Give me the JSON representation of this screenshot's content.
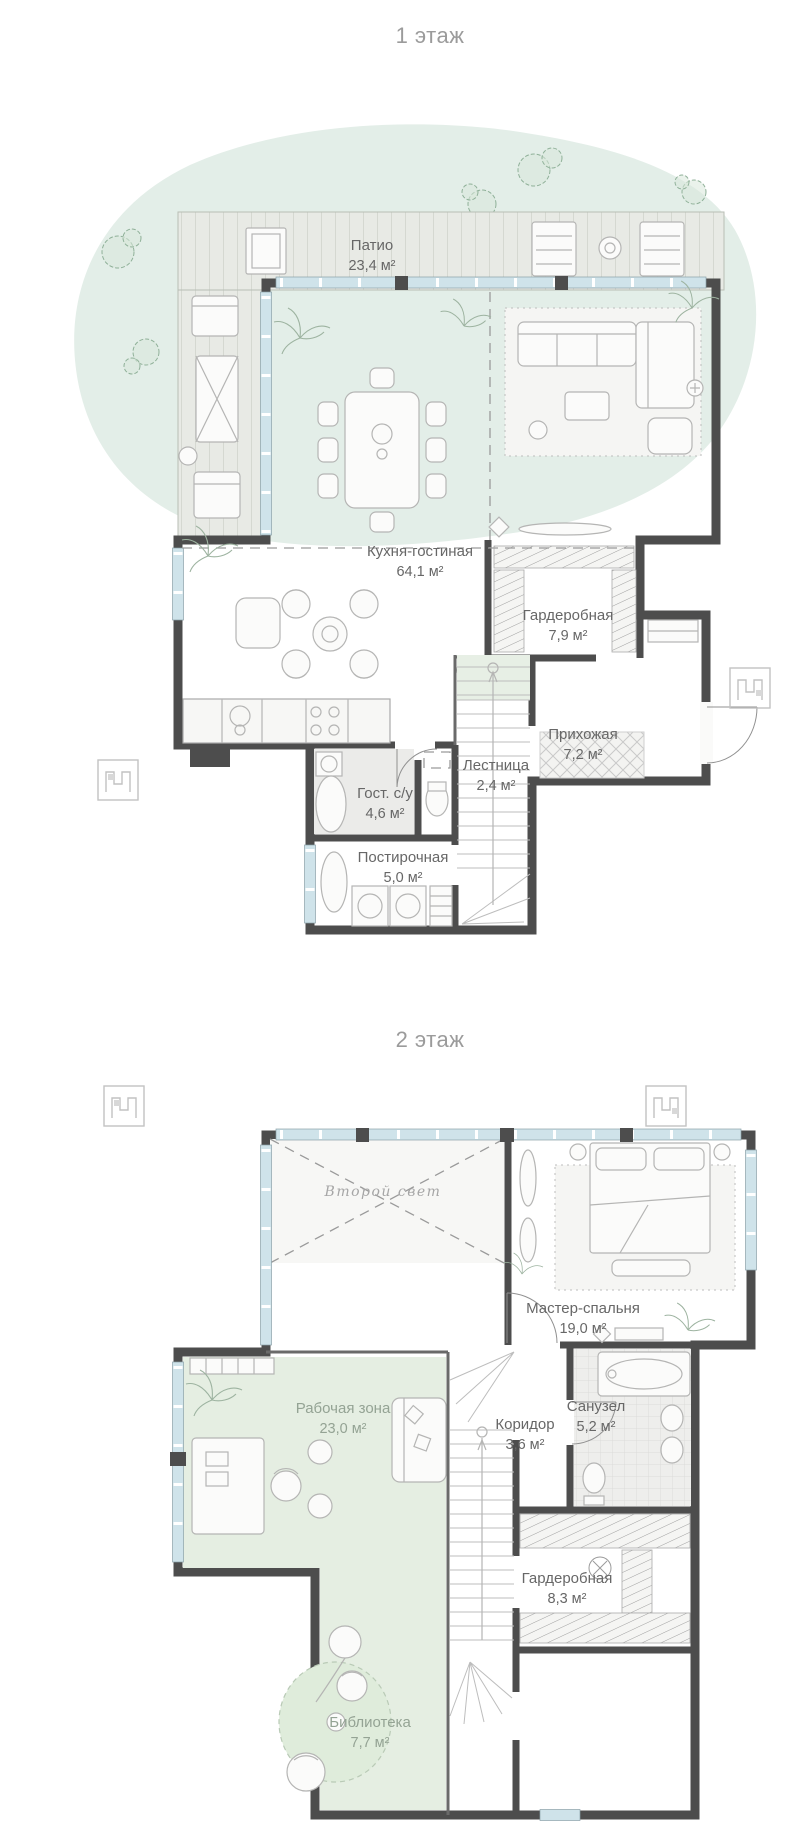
{
  "document": {
    "type": "apartment floor plan, two levels"
  },
  "floor1": {
    "title": "1 этаж",
    "patio": {
      "name": "Патио",
      "area": "23,4 м²"
    },
    "rooms": {
      "kitchen_living": {
        "name": "Кухня-гостиная",
        "area": "64,1 м²"
      },
      "wardrobe": {
        "name": "Гардеробная",
        "area": "7,9 м²"
      },
      "hallway": {
        "name": "Прихожая",
        "area": "7,2 м²"
      },
      "stairs": {
        "name": "Лестница",
        "area": "2,4 м²"
      },
      "guest_bathroom": {
        "name": "Гост. с/у",
        "area": "4,6 м²"
      },
      "laundry": {
        "name": "Постирочная",
        "area": "5,0 м²"
      }
    }
  },
  "floor2": {
    "title": "2 этаж",
    "rooms": {
      "void": {
        "name": "Второй свет"
      },
      "master_bedroom": {
        "name": "Мастер-спальня",
        "area": "19,0 м²"
      },
      "work_zone": {
        "name": "Рабочая зона",
        "area": "23,0 м²"
      },
      "corridor": {
        "name": "Коридор",
        "area": "3,6 м²"
      },
      "bathroom": {
        "name": "Санузел",
        "area": "5,2 м²"
      },
      "wardrobe": {
        "name": "Гардеробная",
        "area": "8,3 м²"
      },
      "library": {
        "name": "Библиотека",
        "area": "7,7 м²"
      }
    }
  },
  "colors": {
    "walls": "#4d4d4d",
    "windows": "#cfe3ea",
    "floor": "#f1f1ef",
    "deck": "#e8eae5",
    "lawn_blob": "#e3eee8",
    "green_zone": "#e5eee2",
    "label_text": "#676767",
    "title_text": "#9b9b9b"
  }
}
